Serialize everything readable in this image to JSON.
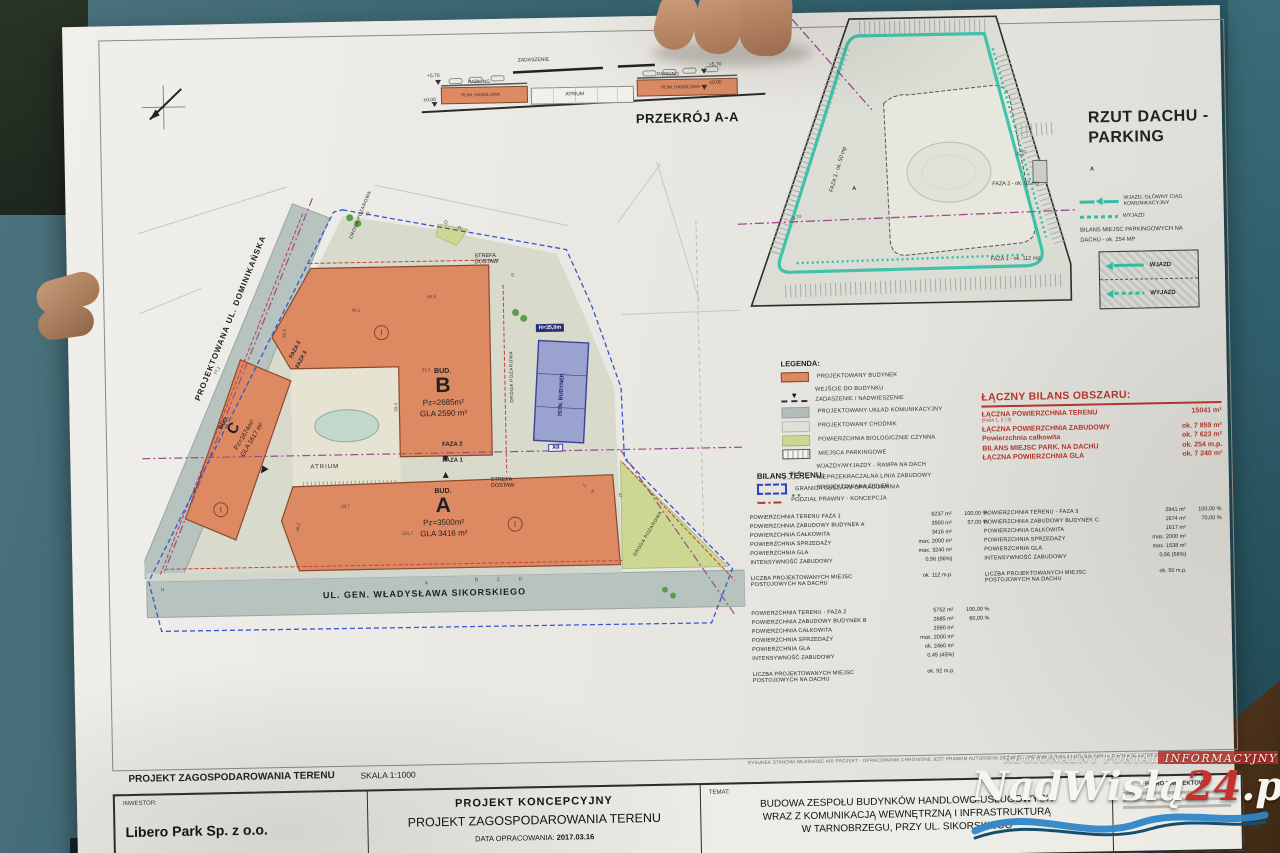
{
  "watermark": {
    "tagline": "REGIONALNY PORTAL INFORMACYJNY",
    "name_a": "NadWisłą",
    "name_b": "24",
    "name_c": ".pl"
  },
  "crosssection": {
    "title": "PRZEKRÓJ A-A",
    "zadaszenie": "ZADASZENIE",
    "parking_l": "PARKING",
    "parking_r": "PARKING",
    "pow_l": "POW. HANDLOWA",
    "pow_r": "POW. HANDLOWA",
    "atrium": "ATRIUM",
    "lvl_top_l": "+5,70",
    "lvl_zero_l": "±0,00",
    "lvl_top_r": "+5,70",
    "lvl_zero_r": "±0,00"
  },
  "roof": {
    "title_line1": "RZUT DACHU -",
    "title_line2": "PARKING",
    "legend": {
      "wjazd1": "WJAZD, GŁÓWNY CIĄG",
      "wjazd2": "KOMUNIKACYJNY",
      "wyjazd": "WYJAZD",
      "bilans1": "BILANS MIEJSC PARKINGOWYCH NA",
      "bilans2": "DACHU - ok. 254 MP"
    },
    "ramp": {
      "wjazd": "WJAZD",
      "wyjazd": "WYJAZD"
    },
    "faza1": "FAZA 1 - ok. 112 mp",
    "faza2": "FAZA 2 - ok. 92 mp",
    "faza3": "FAZA 3 - ok. 50 mp",
    "lvl1": "+5,70",
    "lvl2": "+5,70",
    "marker_a": "A",
    "marker_a2": "A"
  },
  "siteplan": {
    "street_left": "PROJEKTOWANA UL. DOMINIKAŃSKA",
    "street_bottom": "UL. GEN. WŁADYSŁAWA SIKORSKIEGO",
    "bud_b_pre": "BUD.",
    "bud_b": "B",
    "bud_b_1": "Pz=2685m²",
    "bud_b_2": "GLA 2590 m²",
    "bud_a_pre": "BUD.",
    "bud_a": "A",
    "bud_a_1": "Pz=3500m²",
    "bud_a_2": "GLA 3416 m²",
    "bud_c_pre": "BUD.",
    "bud_c": "C",
    "bud_c_1": "Pz=1674m²",
    "bud_c_2": "GLA 1617 m²",
    "atrium": "ATRIUM",
    "faza2": "FAZA 2",
    "faza1": "FAZA 1",
    "faza3r_a": "FAZA 2",
    "faza3r_b": "FAZA 3",
    "strefa1a": "STREFA",
    "strefa1b": "DOSTAW",
    "strefa2a": "STREFA",
    "strefa2b": "DOSTAW",
    "droga1": "DROGA POŻAROWA",
    "droga2": "DROGA POŻAROWA",
    "droga3": "DROGA POŻAROWA",
    "istn": "ISTN. BUDYNEK",
    "h_label": "H=35,0m",
    "xii": "XII",
    "ring_b": "I",
    "ring_a": "I",
    "ring_c": "I",
    "dims": [
      {
        "t": "60,9",
        "x": 288,
        "y": 128,
        "r": 0
      },
      {
        "t": "46,1",
        "x": 212,
        "y": 140,
        "r": 0
      },
      {
        "t": "31,4",
        "x": 281,
        "y": 201,
        "r": 0
      },
      {
        "t": "33,4",
        "x": 250,
        "y": 238,
        "r": -90
      },
      {
        "t": "58,7",
        "x": 198,
        "y": 336,
        "r": 0
      },
      {
        "t": "36,2",
        "x": 150,
        "y": 356,
        "r": -78
      },
      {
        "t": "131,7",
        "x": 258,
        "y": 364,
        "r": 0
      },
      {
        "t": "35,4",
        "x": 140,
        "y": 162,
        "r": -90
      },
      {
        "t": "77,1",
        "x": 72,
        "y": 198,
        "r": -60
      }
    ],
    "markers": [
      {
        "t": "O",
        "x": 228,
        "y": 44
      },
      {
        "t": "Q",
        "x": 306,
        "y": 54
      },
      {
        "t": "R",
        "x": 320,
        "y": 60
      },
      {
        "t": "S",
        "x": 372,
        "y": 108
      },
      {
        "t": "V",
        "x": 440,
        "y": 320
      },
      {
        "t": "A",
        "x": 448,
        "y": 326
      },
      {
        "t": "E",
        "x": 476,
        "y": 330
      },
      {
        "t": "H",
        "x": 16,
        "y": 416
      },
      {
        "t": "A",
        "x": 280,
        "y": 414
      },
      {
        "t": "B",
        "x": 330,
        "y": 412
      },
      {
        "t": "C",
        "x": 352,
        "y": 412
      },
      {
        "t": "D",
        "x": 374,
        "y": 412
      }
    ]
  },
  "legend": {
    "title": "LEGENDA:",
    "items": [
      {
        "label": "PROJEKTOWANY BUDYNEK",
        "sw": "sw-bld"
      },
      {
        "label": "WEJŚCIE DO BUDYNKU",
        "sw": "sw-entry"
      },
      {
        "label": "ZADASZENIE / NADWIESZENIE",
        "sw": "sw-dash"
      },
      {
        "label": "PROJEKTOWANY UKŁAD KOMUNIKACYJNY",
        "sw": "sw-road"
      },
      {
        "label": "PROJEKTOWANY CHODNIK",
        "sw": "sw-walk"
      },
      {
        "label": "POWIERZCHNIA BIOLOGICZNIE CZYNNA",
        "sw": "sw-bio"
      },
      {
        "label": "MIEJSCA PARKINGOWE",
        "sw": "sw-mp"
      },
      {
        "label": "WJAZDY/WYJAZDY - RAMPA NA DACH",
        "sw": "sw-ramp"
      },
      {
        "label": "NIEPRZEKRACZALNA LINIA ZABUDOWY",
        "sw": "sw-line"
      },
      {
        "label": "PROJEKTOWANA ZIELEŃ",
        "sw": "sw-green"
      }
    ]
  },
  "bilans": {
    "title": "BILANS TERENU:",
    "items": [
      {
        "label": "GRANICA OBSZARU OPRACOWANIA",
        "sw": "sw-granica"
      },
      {
        "label": "PODZIAŁ PRAWNY - KONCEPCJA",
        "sw": "sw-podzial"
      }
    ]
  },
  "summary": {
    "title": "ŁĄCZNY BILANS OBSZARU:",
    "rows": [
      {
        "label": "ŁĄCZNA POWIERZCHNIA TERENU",
        "sub": "(Faza 1, 2 i 3)",
        "value": "15041 m²",
        "bold": true
      },
      {
        "label": "ŁĄCZNA POWIERZCHNIA ZABUDOWY",
        "value": "ok. 7 859 m²",
        "bold": true
      },
      {
        "label": "Powierzchnia całkowita",
        "value": "ok. 7 623 m²",
        "bold": true
      },
      {
        "label": "BILANS MIEJSC PARK. NA DACHU",
        "value": "ok. 254 m.p.",
        "bold": true
      },
      {
        "label": "ŁĄCZNA POWIERZCHNIA GLA",
        "value": "ok. 7 240 m²",
        "bold": true
      }
    ]
  },
  "tables": {
    "faza1": {
      "rows": [
        {
          "label": "POWIERZCHNIA TERENU  FAZA 1",
          "value": "6237 m²",
          "pct": "100,00 %"
        },
        {
          "label": "POWIERZCHNIA ZABUDOWY BUDYNEK  A",
          "value": "3500 m²",
          "pct": "57,00 %"
        },
        {
          "label": "POWIERZCHNIA CAŁKOWITA",
          "value": "3416 m²"
        },
        {
          "label": "POWIERZCHNIA SPRZEDAŻY",
          "value": "max. 2000 m²"
        },
        {
          "label": "POWIERZCHNIA GLA",
          "value": "max. 3240 m²"
        },
        {
          "label": "INTENSYWNOŚĆ ZABUDOWY",
          "value": "0,56 (56%)"
        },
        {
          "label": "LICZBA PROJEKTOWANYCH MIEJSC POSTOJOWYCH NA DACHU",
          "value": "ok. 112 m.p.",
          "gap": true
        }
      ]
    },
    "faza2": {
      "rows": [
        {
          "label": "POWIERZCHNIA TERENU - FAZA 2",
          "value": "5752 m²",
          "pct": "100,00 %"
        },
        {
          "label": "POWIERZCHNIA ZABUDOWY BUDYNEK  B",
          "value": "2685 m²",
          "pct": "60,00 %"
        },
        {
          "label": "POWIERZCHNIA CAŁKOWITA",
          "value": "2590 m²"
        },
        {
          "label": "POWIERZCHNIA SPRZEDAŻY",
          "value": "max. 2000 m²"
        },
        {
          "label": "POWIERZCHNIA GLA",
          "value": "ok. 2460 m²"
        },
        {
          "label": "INTENSYWNOŚĆ ZABUDOWY",
          "value": "0,45 (45%)"
        },
        {
          "label": "LICZBA PROJEKTOWANYCH MIEJSC POSTOJOWYCH NA DACHU",
          "value": "ok. 92 m.p.",
          "gap": true
        }
      ]
    },
    "faza3": {
      "rows": [
        {
          "label": "POWIERZCHNIA TERENU - FAZA 3",
          "value": "2941 m²",
          "pct": "100,00 %"
        },
        {
          "label": "POWIERZCHNIA ZABUDOWY BUDYNEK  C",
          "value": "1674 m²",
          "pct": "70,00 %"
        },
        {
          "label": "POWIERZCHNIA CAŁKOWITA",
          "value": "1617 m²"
        },
        {
          "label": "POWIERZCHNIA SPRZEDAŻY",
          "value": "max. 2000 m²"
        },
        {
          "label": "POWIERZCHNIA GLA",
          "value": "max. 1538 m²"
        },
        {
          "label": "INTENSYWNOŚĆ ZABUDOWY",
          "value": "0,56 (56%)"
        },
        {
          "label": "LICZBA PROJEKTOWANYCH MIEJSC POSTOJOWYCH NA DACHU",
          "value": "ok. 50 m.p.",
          "gap": true
        }
      ]
    }
  },
  "titlebar": {
    "main": "PROJEKT ZAGOSPODAROWANIA TERENU",
    "scale": "SKALA 1:1000",
    "disclaimer": "RYSUNEK STANOWI WŁASNOŚĆ AIR PROJEKT - OPRACOWANIE CHRONIONE JEST PRAWEM AUTORSKIM ZGODNIE Z USTAWĄ Z DNIA 4 LUTEGO 1994 R. O PRAWIE AUTORSKIM I PRAWACH POKREWNYCH"
  },
  "titleblock": {
    "investor_label": "INWESTOR:",
    "investor": "Libero Park Sp. z o.o.",
    "concept": "PROJEKT KONCEPCYJNY",
    "concept2": "PROJEKT ZAGOSPODAROWANIA TERENU",
    "date_label": "DATA OPRACOWANIA:",
    "date": "2017.03.16",
    "temat_label": "TEMAT:",
    "temat1": "BUDOWA ZESPOŁU BUDYNKÓW  HANDLOWO-USŁUGOWYCH",
    "temat2": "WRAZ Z KOMUNIKACJĄ WEWNĘTRZNĄ I INFRASTRUKTURĄ",
    "temat3": "W TARNOBRZEGU, PRZY UL. SIKORSKIEGO",
    "biuro": "BIURO PROJEKTOWE"
  }
}
